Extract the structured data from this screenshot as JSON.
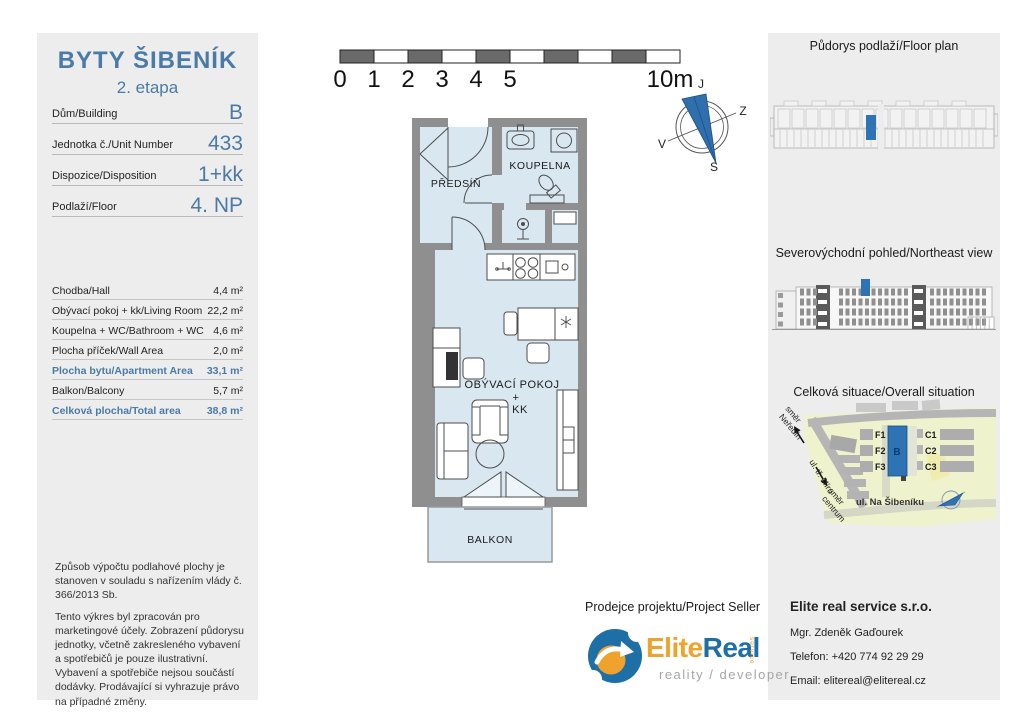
{
  "colors": {
    "accent_blue": "#4a7aa8",
    "highlight_blue": "#2e74b5",
    "wall_gray": "#8f8f8f",
    "room_blue": "#d9e7f1",
    "panel_gray": "#ededed",
    "logo_orange": "#f0a32c",
    "logo_blue": "#1d6fa5"
  },
  "left_panel": {
    "title": "BYTY ŠIBENÍK",
    "subtitle": "2. etapa",
    "info_rows": [
      {
        "label": "Dům/Building",
        "value": "B"
      },
      {
        "label": "Jednotka č./Unit Number",
        "value": "433"
      },
      {
        "label": "Dispozice/Disposition",
        "value": "1+kk"
      },
      {
        "label": "Podlaží/Floor",
        "value": "4. NP"
      }
    ],
    "area_rows": [
      {
        "label": "Chodba/Hall",
        "value": "4,4 m²"
      },
      {
        "label": "Obývací pokoj + kk/Living Room",
        "value": "22,2 m²"
      },
      {
        "label": "Koupelna + WC/Bathroom + WC",
        "value": "4,6 m²"
      },
      {
        "label": "Plocha příček/Wall Area",
        "value": "2,0 m²"
      },
      {
        "label": "Plocha bytu/Apartment Area",
        "value": "33,1 m²",
        "highlight": true
      },
      {
        "label": "Balkon/Balcony",
        "value": "5,7 m²"
      },
      {
        "label": "Celková plocha/Total area",
        "value": "38,8 m²",
        "highlight": true
      }
    ],
    "disclaimer_p1": "Způsob výpočtu podlahové plochy je stanoven v souladu s nařízením vlády č. 366/2013 Sb.",
    "disclaimer_p2": "Tento výkres byl zpracován pro marketingové účely. Zobrazení půdorysu jednotky, včetně zakresleného vybavení a spotřebičů je pouze ilustrativní. Vybavení a spotřebiče nejsou součástí dodávky. Prodávající si vyhrazuje právo na případné změny."
  },
  "plan": {
    "scale_ticks": [
      "0",
      "1",
      "2",
      "3",
      "4",
      "5"
    ],
    "scale_end": "10m",
    "compass": {
      "top": "J",
      "right": "Z",
      "left": "V",
      "bottom": "S"
    },
    "rooms": {
      "hall": "PŘEDSÍŇ",
      "bathroom": "KOUPELNA",
      "living_line1": "OBÝVACÍ POKOJ",
      "living_line2": "+",
      "living_line3": "KK",
      "balcony": "BALKON"
    }
  },
  "right_panel": {
    "floorplan_title": "Půdorys podlaží/Floor plan",
    "elevation_title": "Severovýchodní pohled/Northeast view",
    "situation_title": "Celková situace/Overall situation",
    "site": {
      "buildings": {
        "f1": "F1",
        "f2": "F2",
        "f3": "F3",
        "b": "B",
        "c1": "C1",
        "c2": "C2",
        "c3": "C3"
      },
      "street": "ul. Na Šibeníku",
      "road_label": "ul. tř. Míru",
      "dir_nw_1": "směr",
      "dir_nw_2": "Neředín",
      "dir_se_1": "směr",
      "dir_se_2": "centrum"
    }
  },
  "seller": {
    "heading": "Prodejce projektu/Project Seller",
    "logo_part1": "Elite",
    "logo_part2": "Real",
    "logo_service": "service",
    "logo_tagline": "reality / developer",
    "company": "Elite real service s.r.o.",
    "name": "Mgr. Zdeněk Gaďourek",
    "phone": "Telefon: +420 774 92 29 29",
    "email": "Email: elitereal@elitereal.cz"
  }
}
